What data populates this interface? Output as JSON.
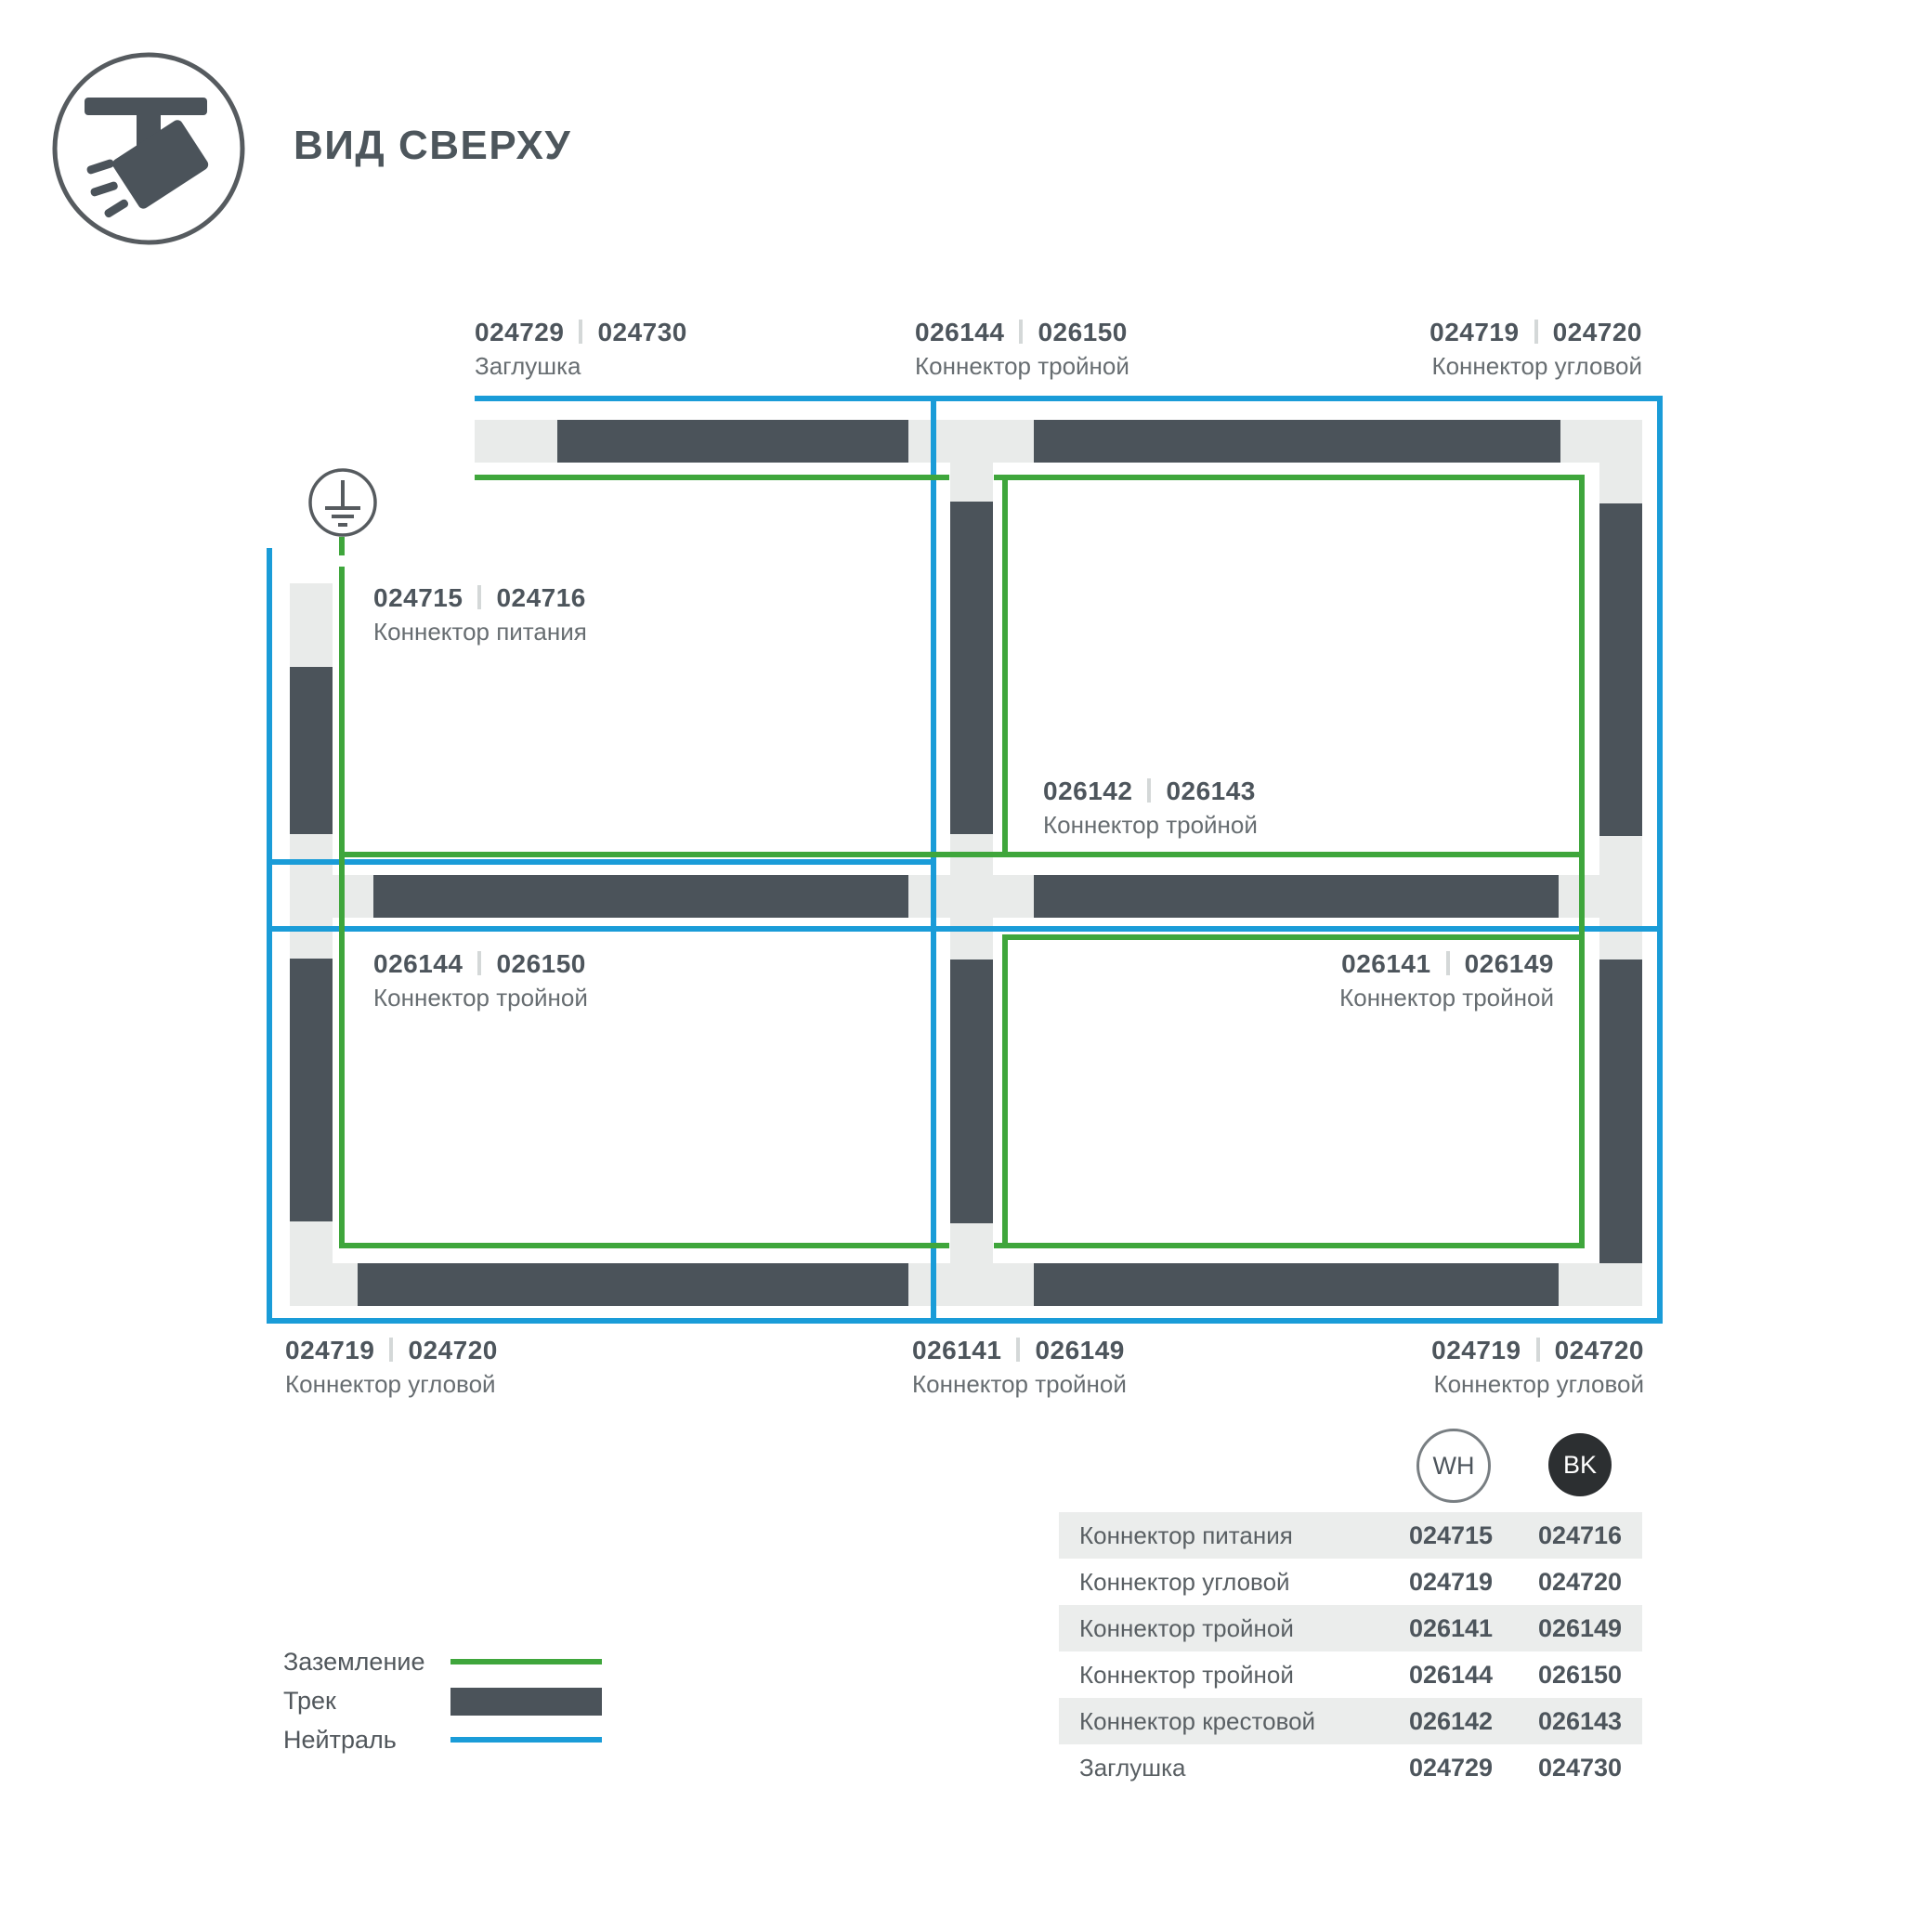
{
  "header": {
    "title": "ВИД СВЕРХУ"
  },
  "diagram": {
    "labels": [
      {
        "c1": "024729",
        "c2": "024730",
        "name": "Заглушка"
      },
      {
        "c1": "026144",
        "c2": "026150",
        "name": "Коннектор тройной"
      },
      {
        "c1": "024719",
        "c2": "024720",
        "name": "Коннектор угловой"
      },
      {
        "c1": "024715",
        "c2": "024716",
        "name": "Коннектор питания"
      },
      {
        "c1": "026142",
        "c2": "026143",
        "name": "Коннектор тройной"
      },
      {
        "c1": "026144",
        "c2": "026150",
        "name": "Коннектор тройной"
      },
      {
        "c1": "026141",
        "c2": "026149",
        "name": "Коннектор тройной"
      },
      {
        "c1": "024719",
        "c2": "024720",
        "name": "Коннектор угловой"
      },
      {
        "c1": "026141",
        "c2": "026149",
        "name": "Коннектор тройной"
      },
      {
        "c1": "024719",
        "c2": "024720",
        "name": "Коннектор угловой"
      }
    ]
  },
  "legend": {
    "items": [
      {
        "label": "Заземление",
        "color": "#3fa63c"
      },
      {
        "label": "Трек",
        "color": "#4b535a"
      },
      {
        "label": "Нейтраль",
        "color": "#1a9cd8"
      }
    ]
  },
  "table": {
    "badges": [
      {
        "code": "WH"
      },
      {
        "code": "BK"
      }
    ],
    "rows": [
      {
        "name": "Коннектор питания",
        "wh": "024715",
        "bk": "024716"
      },
      {
        "name": "Коннектор угловой",
        "wh": "024719",
        "bk": "024720"
      },
      {
        "name": "Коннектор тройной",
        "wh": "026141",
        "bk": "026149"
      },
      {
        "name": "Коннектор тройной",
        "wh": "026144",
        "bk": "026150"
      },
      {
        "name": "Коннектор крестовой",
        "wh": "026142",
        "bk": "026143"
      },
      {
        "name": "Заглушка",
        "wh": "024729",
        "bk": "024730"
      }
    ]
  },
  "colors": {
    "track": "#4b535a",
    "channel": "#e9ebea",
    "ground": "#3fa63c",
    "neutral": "#1a9cd8"
  }
}
